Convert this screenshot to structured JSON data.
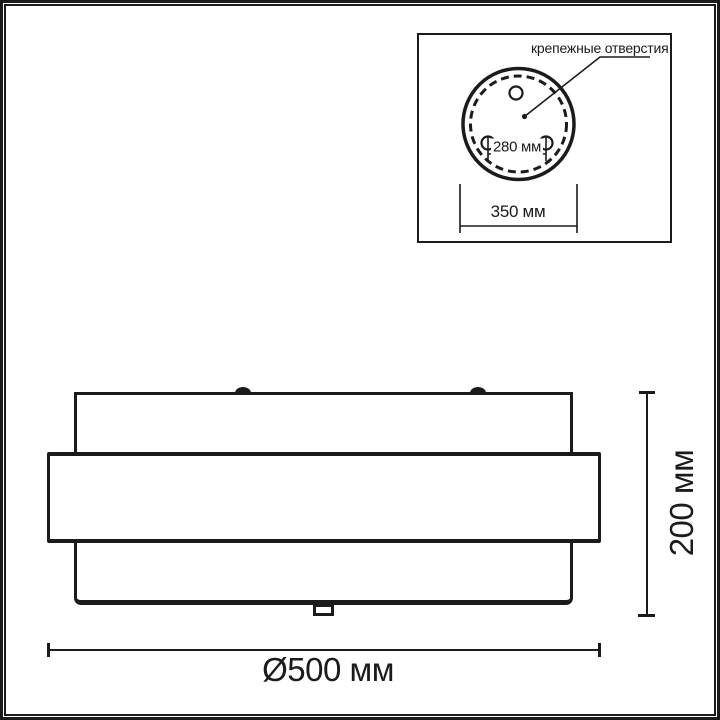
{
  "page": {
    "background": "#ffffff",
    "line_color": "#1b1b1b"
  },
  "inset": {
    "label": "крепежные отверстия",
    "hole_spacing": "280 мм",
    "plate_diameter": "350 мм"
  },
  "front_view": {
    "height": "200 мм",
    "diameter": "Ø500 мм"
  }
}
